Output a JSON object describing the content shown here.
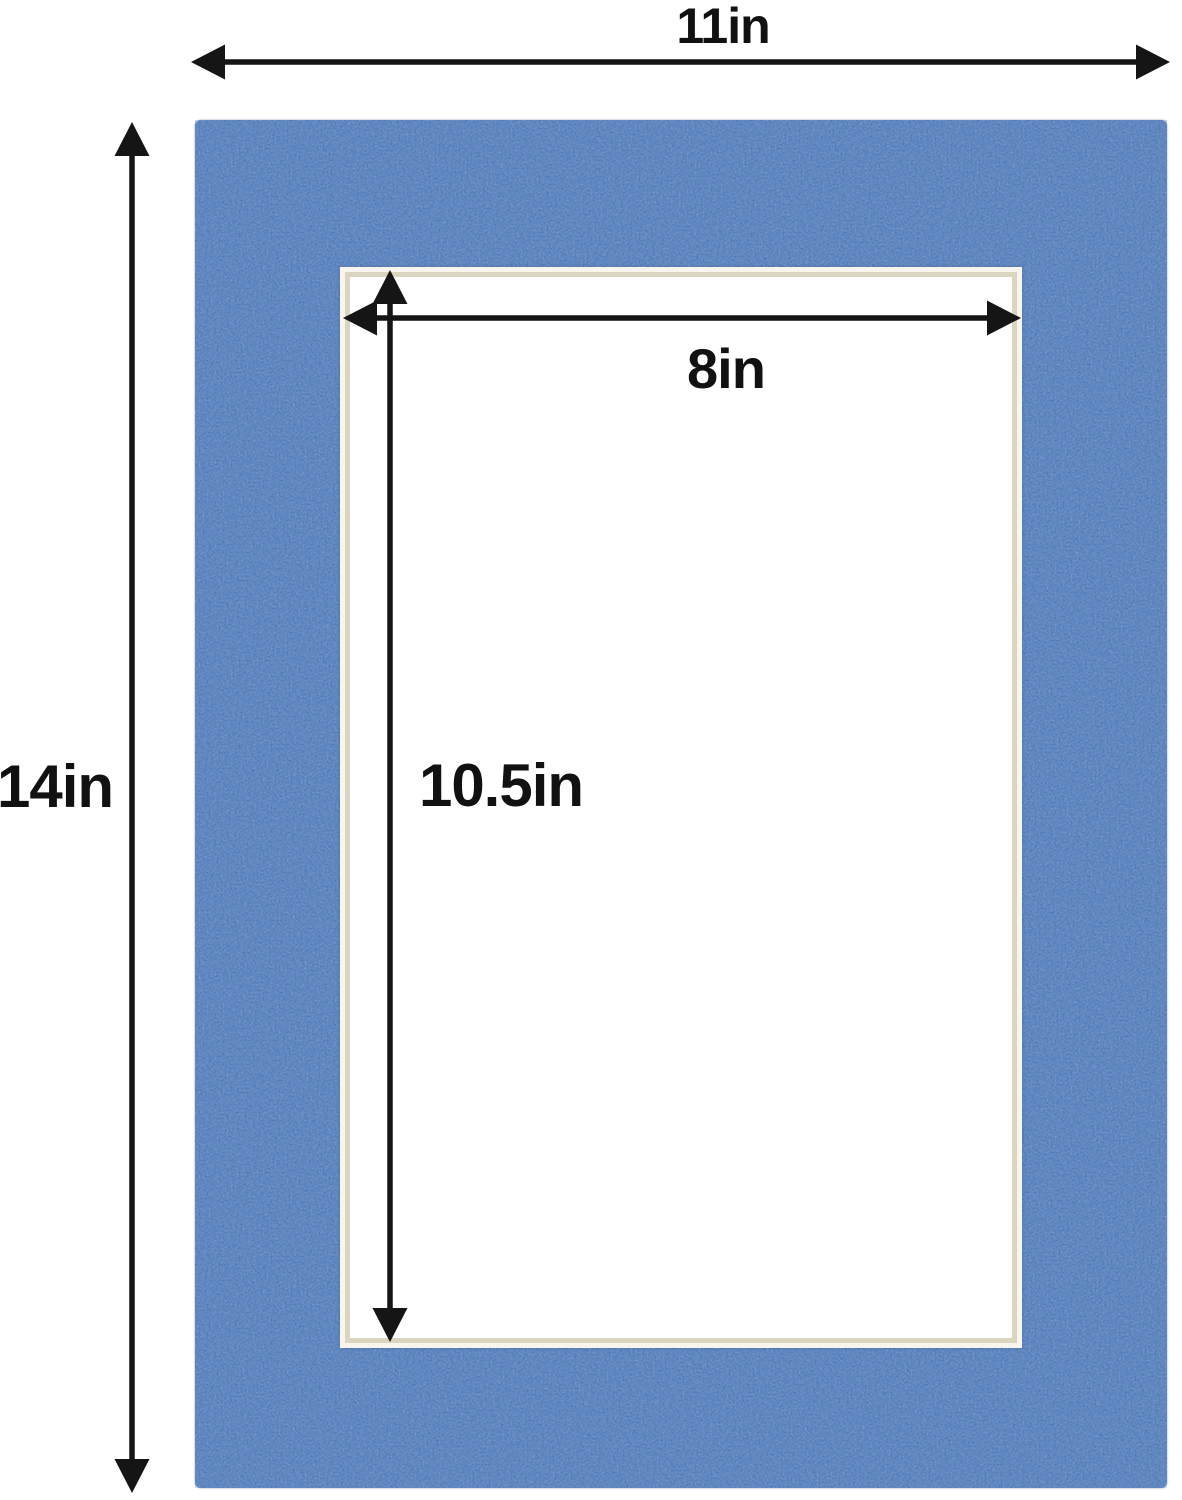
{
  "dimensions": {
    "outer_width": "11in",
    "outer_height": "14in",
    "opening_width": "8in",
    "opening_height": "10.5in"
  },
  "colors": {
    "background": "#ffffff",
    "mat_blue": "#3e6bb2",
    "mat_blue_dark": "#2e5696",
    "bevel_cream": "#dbd5c0",
    "bevel_white": "#f7f5ee",
    "opening_white": "#ffffff",
    "arrow_black": "#151515"
  }
}
